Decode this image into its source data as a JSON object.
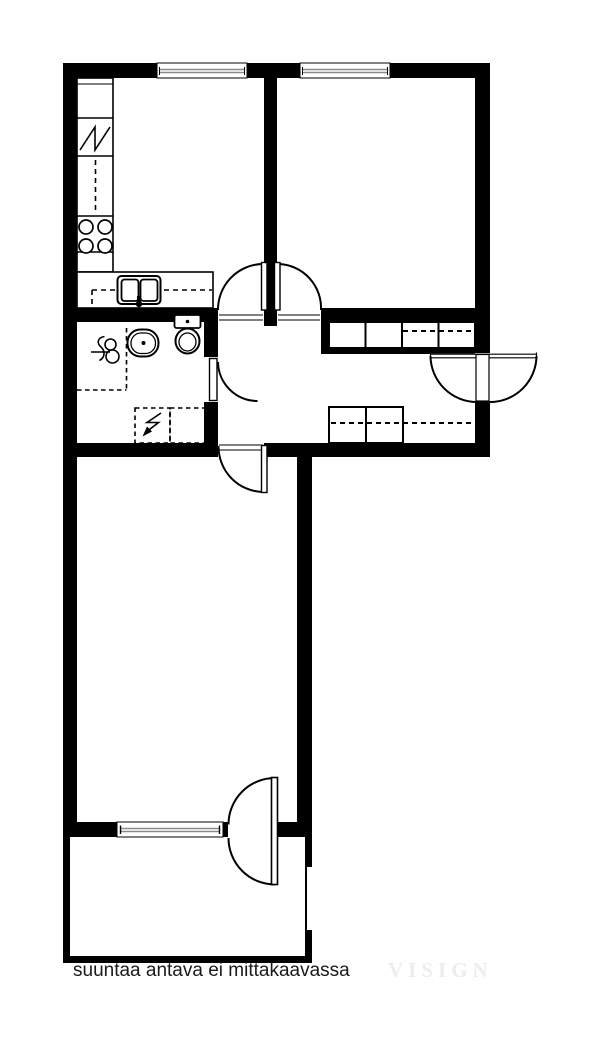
{
  "caption": {
    "text": "suuntaa antava ei mittakaavassa"
  },
  "watermark": {
    "text": "VISIGN"
  },
  "colors": {
    "walls": "#000000",
    "background": "#ffffff",
    "window_glazing": "#8a8a8a",
    "caption_text": "#1a1a1a",
    "watermark_text": "#efeceb"
  },
  "plan_symbols": {
    "stove": "stove-icon",
    "sink": "double-sink-icon",
    "fridge": "fridge-zigzag-icon",
    "toilet": "toilet-icon",
    "washbasin": "washbasin-icon",
    "shower": "shower-mixer-icon",
    "appliance_reservation": "dashed-reservation-icon",
    "wardrobe": "wardrobe-cells",
    "door_swing": "door-arc",
    "window": "window-double-line"
  }
}
